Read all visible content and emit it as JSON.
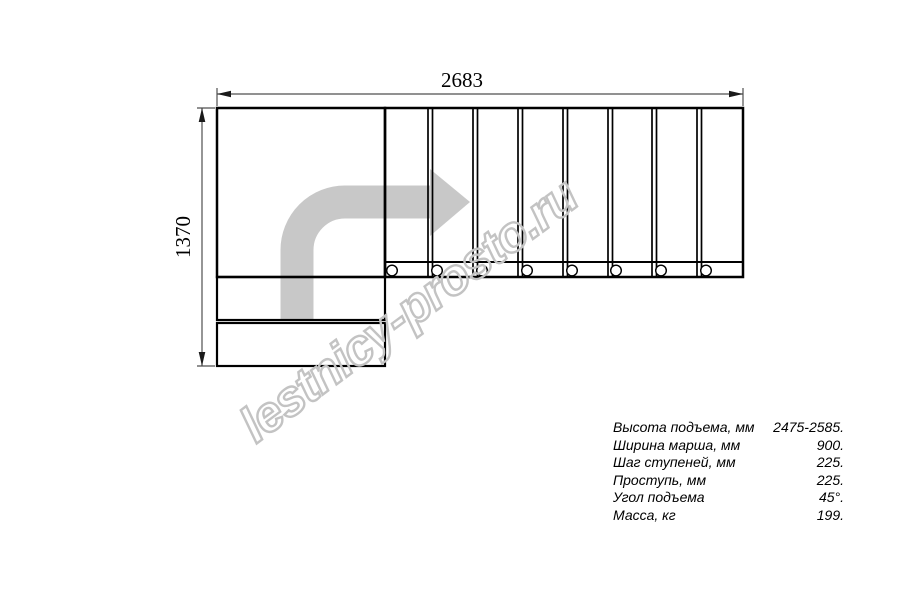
{
  "drawing": {
    "title": "staircase plan view (quarter-turn left, 8 upper treads, landing, 2 lower treads)",
    "width_dimension": "2683",
    "height_dimension": "1370"
  },
  "watermark": {
    "text": "lestnicy-prosto.ru"
  },
  "specs": {
    "rows": [
      {
        "label": "Высота подъема, мм",
        "value": "2475-2585."
      },
      {
        "label": "Ширина марша, мм",
        "value": "900."
      },
      {
        "label": "Шаг ступеней, мм",
        "value": "225."
      },
      {
        "label": "Проступь, мм",
        "value": "225."
      },
      {
        "label": "Угол подъема",
        "value": "45°."
      },
      {
        "label": "Масса, кг",
        "value": "199."
      }
    ]
  },
  "colors": {
    "outline": "#000000",
    "dimension_line": "#4f4f4f",
    "direction_arrow": "#c8c8c8",
    "watermark": "#c3c3c3",
    "background": "#ffffff"
  }
}
